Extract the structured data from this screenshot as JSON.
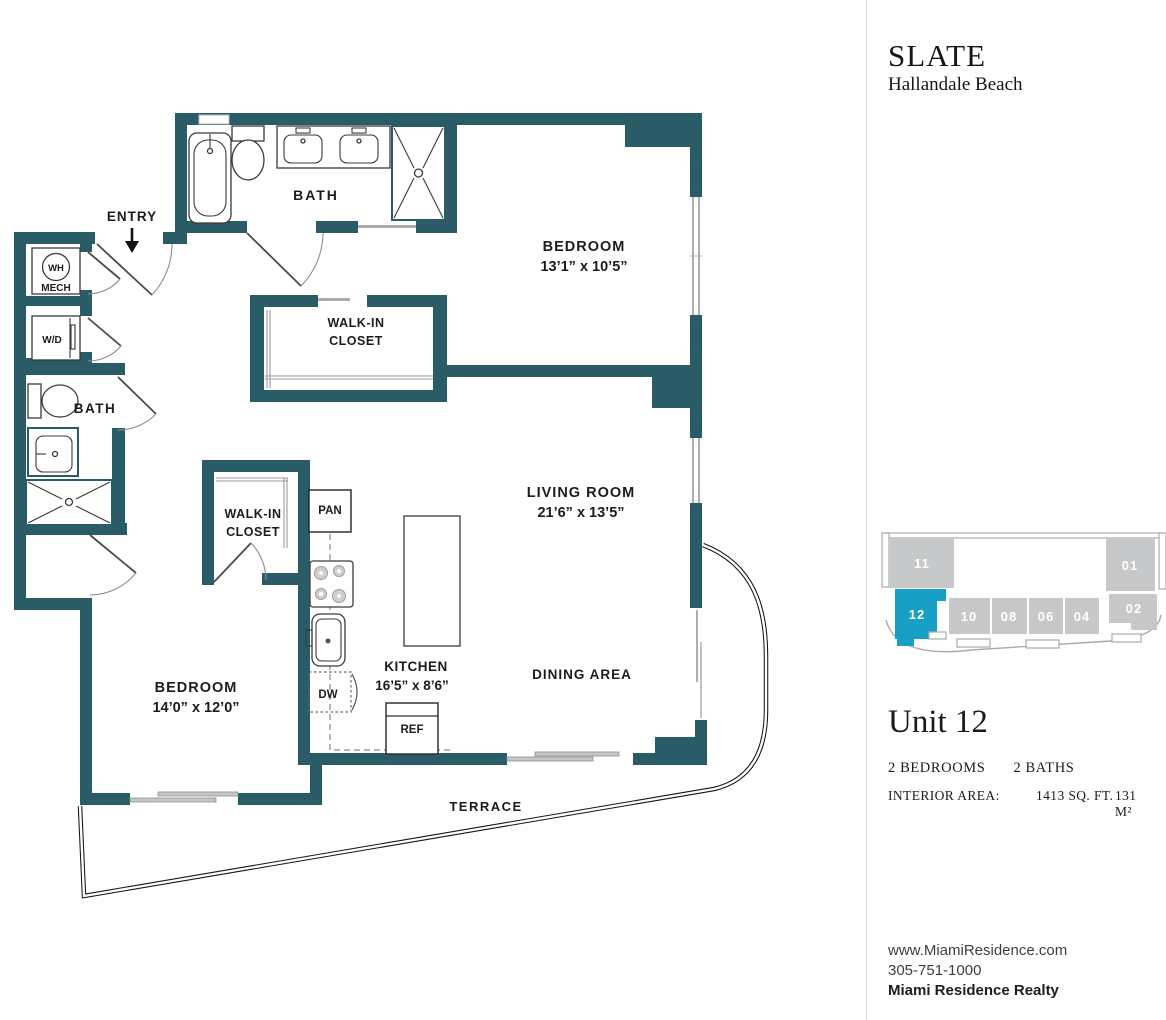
{
  "branding": {
    "name": "SLATE",
    "location": "Hallandale Beach"
  },
  "colors": {
    "wall": "#295C66",
    "keyplan_highlight": "#189FC6",
    "keyplan_unit_grey": "#C7C8C9"
  },
  "floorplan": {
    "labels": {
      "entry": "ENTRY",
      "bath_top": "BATH",
      "bath_left": "BATH",
      "wh": "WH",
      "mech": "MECH",
      "wd": "W/D",
      "bedroom1": "BEDROOM",
      "bedroom1_dims": "13’1” x 10’5”",
      "bedroom2": "BEDROOM",
      "bedroom2_dims": "14’0” x 12’0”",
      "walkin1_line1": "WALK-IN",
      "walkin1_line2": "CLOSET",
      "walkin2_line1": "WALK-IN",
      "walkin2_line2": "CLOSET",
      "living": "LIVING ROOM",
      "living_dims": "21’6” x 13’5”",
      "kitchen": "KITCHEN",
      "kitchen_dims": "16’5” x 8’6”",
      "dining": "DINING AREA",
      "terrace": "TERRACE",
      "pan": "PAN",
      "dw": "DW",
      "ref": "REF"
    }
  },
  "keyplan": {
    "units": [
      {
        "label": "11"
      },
      {
        "label": "12"
      },
      {
        "label": "10"
      },
      {
        "label": "08"
      },
      {
        "label": "06"
      },
      {
        "label": "04"
      },
      {
        "label": "01"
      },
      {
        "label": "02"
      }
    ]
  },
  "unit_info": {
    "title": "Unit 12",
    "bedrooms": "2 BEDROOMS",
    "baths": "2 BATHS",
    "interior_area_label": "INTERIOR AREA:",
    "area_imperial": "1413 SQ. FT.",
    "area_metric": "131 M²"
  },
  "contact": {
    "website": "www.MiamiResidence.com",
    "phone": "305-751-1000",
    "company": "Miami Residence Realty"
  }
}
